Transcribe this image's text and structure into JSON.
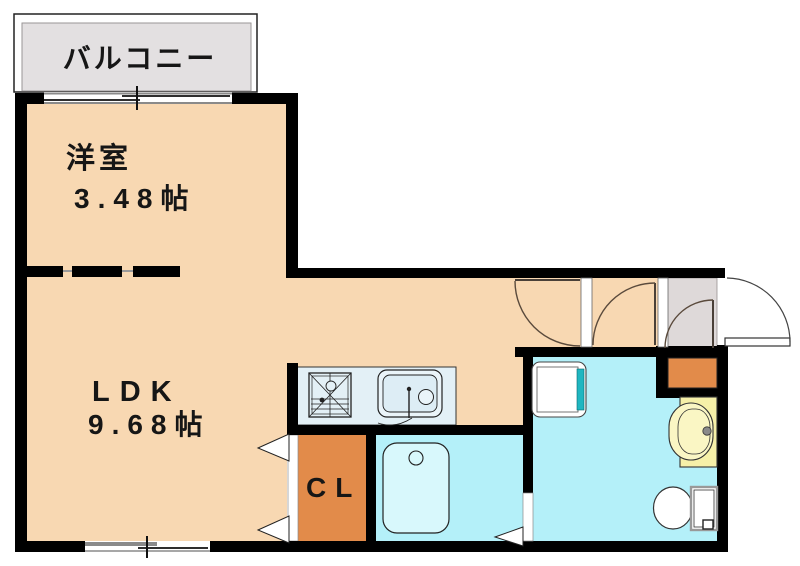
{
  "title": "apartment-floor-plan",
  "labels": {
    "balcony": "バルコニー",
    "western_room": {
      "name": "洋室",
      "size": "3.48帖"
    },
    "ldk": {
      "name": "LDK",
      "size": "9.68帖"
    },
    "closet": "CL"
  },
  "rooms": [
    {
      "name": "バルコニー",
      "type": "balcony"
    },
    {
      "name": "洋室",
      "size_jo": 3.48,
      "type": "western-room"
    },
    {
      "name": "LDK",
      "size_jo": 9.68,
      "type": "living-dining-kitchen"
    },
    {
      "name": "CL",
      "type": "closet"
    },
    {
      "name": "浴室",
      "type": "bathroom-unlabeled"
    },
    {
      "name": "洗面所",
      "type": "washroom-unlabeled"
    },
    {
      "name": "玄関",
      "type": "entry-unlabeled"
    }
  ],
  "icons": {
    "stove": "gas-stove-symbol",
    "sink": "kitchen-sink-symbol",
    "bathtub": "bathtub-symbol",
    "washer_pan": "washing-machine-pan-symbol",
    "vanity": "wash-basin-symbol",
    "toilet": "toilet-symbol",
    "entrance_door": "entrance-door-swing-arc",
    "interior_doors": "door-swing-arcs",
    "closet_doors": "folding-door-triangles",
    "windows": "sliding-window-symbols"
  },
  "colors": {
    "room": "#f8d8b2",
    "closet": "#e28b4a",
    "wet_area": "#b4f0f9",
    "bathtub": "#d8f8fc",
    "counter": "#e3f0f6",
    "entry_floor": "#ded9d9",
    "balcony_floor": "#e3e0e1",
    "vanity": "#f6f0a8",
    "vanity_bowl": "#faf6c4",
    "washer_accent": "#1fb6c1",
    "wall": "#000000"
  }
}
